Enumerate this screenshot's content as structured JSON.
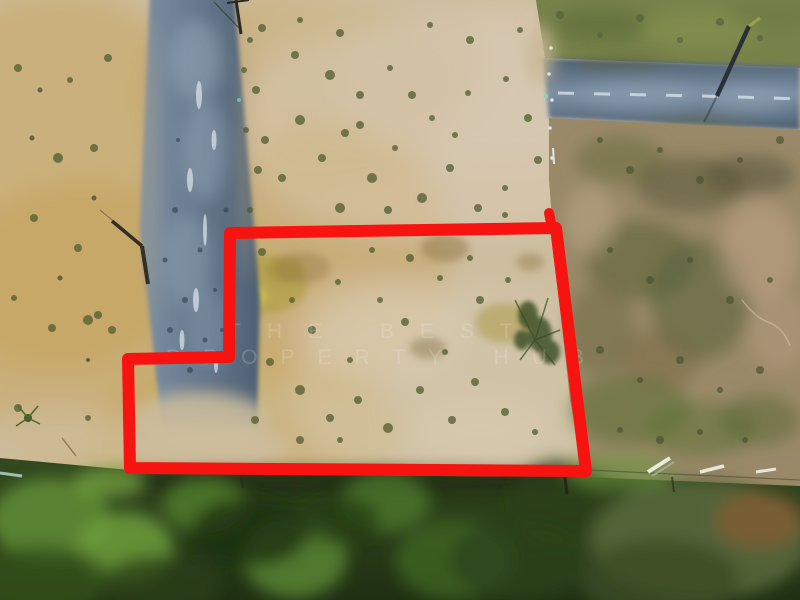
{
  "scene": {
    "description": "Aerial drone photo of a vacant dirt land plot outlined in red",
    "watermark": {
      "line1": "THE BEST",
      "line2": "PROPERTY HUB"
    }
  },
  "palette": {
    "boundary_red": "#f71410",
    "dirt_base": "#cdbd9e",
    "dirt_pale": "#d8ccb5",
    "dirt_gold": "#c29a4d",
    "stain_olive": "#b2a047",
    "road_light": "#7d90a3",
    "road_dark": "#4e6073",
    "scrub_base": "#9a8968",
    "grass_topright": "#77824a",
    "treeline_light": "#33491f",
    "treeline_dark": "#1f3013"
  }
}
